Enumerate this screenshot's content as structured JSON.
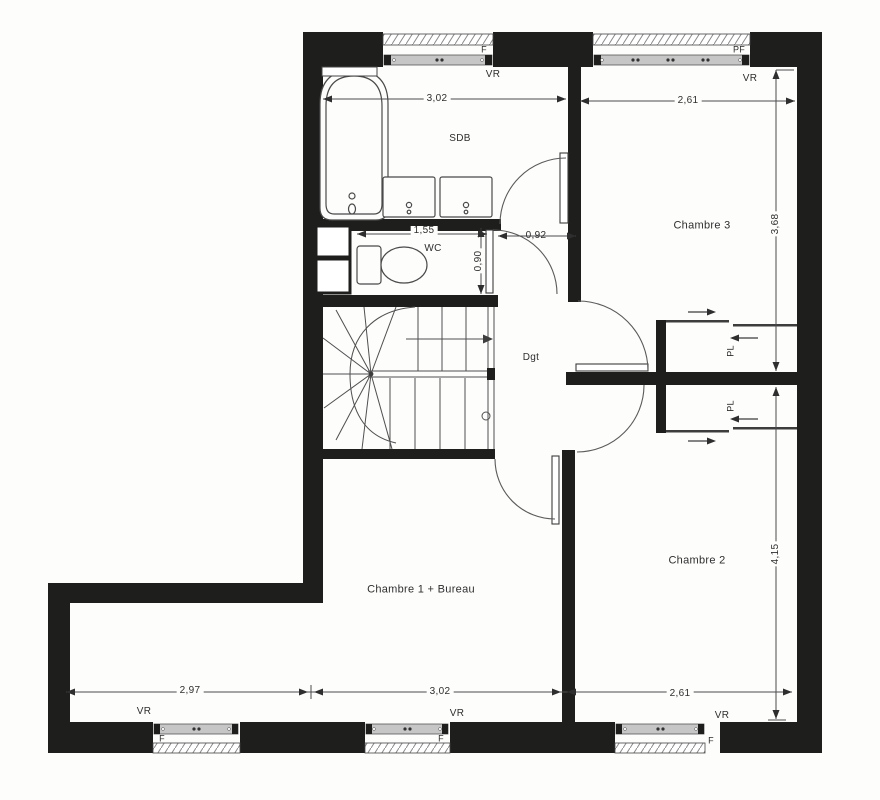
{
  "rooms": {
    "sdb": "SDB",
    "wc": "WC",
    "dgt": "Dgt",
    "chambre3": "Chambre 3",
    "chambre2": "Chambre 2",
    "chambre1": "Chambre 1 + Bureau",
    "pl_top": "PL",
    "pl_bottom": "PL"
  },
  "dimensions": {
    "top_left": "3,02",
    "top_right": "2,61",
    "right_upper": "3,68",
    "right_lower": "4,15",
    "wc_width": "1,55",
    "sdb_door": "0,92",
    "wc_door": "0,90",
    "bottom_left": "2,97",
    "bottom_middle": "3,02",
    "bottom_right": "2,61"
  },
  "openings": {
    "top_window_f": "F",
    "top_window_pf": "PF",
    "top_shutter_left": "VR",
    "top_shutter_right": "VR",
    "bottom_shutter_1": "VR",
    "bottom_window_f1": "F",
    "bottom_shutter_2": "VR",
    "bottom_window_f2": "F",
    "bottom_shutter_3": "VR",
    "bottom_window_f3": "F"
  },
  "colors": {
    "wall": "#1e1e1c",
    "line": "#3d3d3d",
    "dimension": "#4c4c4c",
    "window_frame": "#c6c6c6",
    "paper": "#fdfdfc"
  }
}
